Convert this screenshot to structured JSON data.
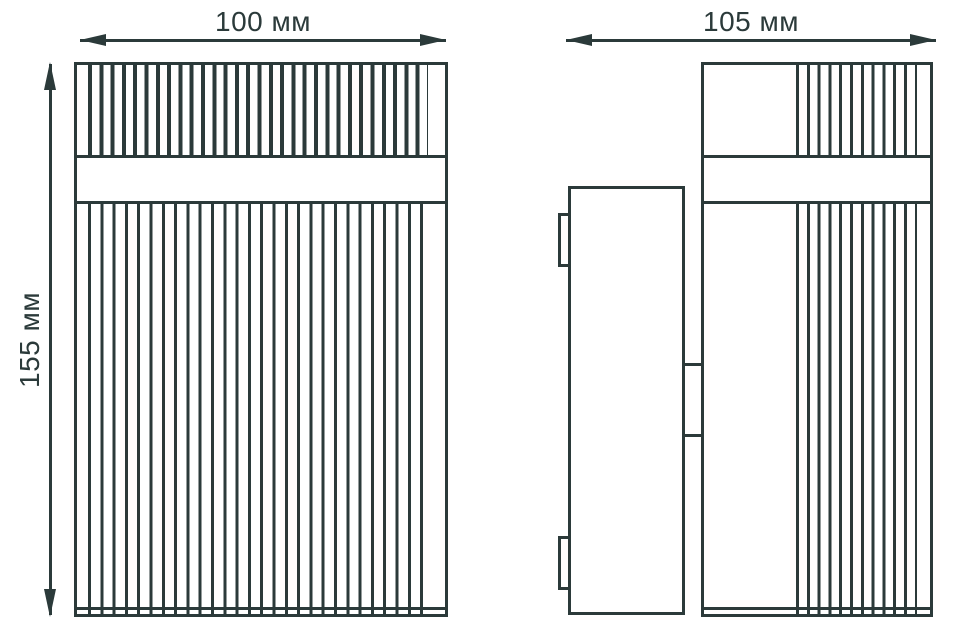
{
  "drawing": {
    "type": "dimensional-technical-drawing",
    "line_color": "#2b3a3a",
    "background_color": "#ffffff",
    "dimensions": {
      "front_width": {
        "label": "100 мм",
        "value": 100,
        "unit": "мм"
      },
      "side_depth": {
        "label": "105 мм",
        "value": 105,
        "unit": "мм"
      },
      "height": {
        "label": "155 мм",
        "value": 155,
        "unit": "мм"
      }
    },
    "views": {
      "front": {
        "name": "front view: ribbed lamp body with plain horizontal band and bottom strip"
      },
      "side": {
        "name": "side view: lamp body with rear wall-mount bracket and two connector tabs"
      }
    }
  }
}
